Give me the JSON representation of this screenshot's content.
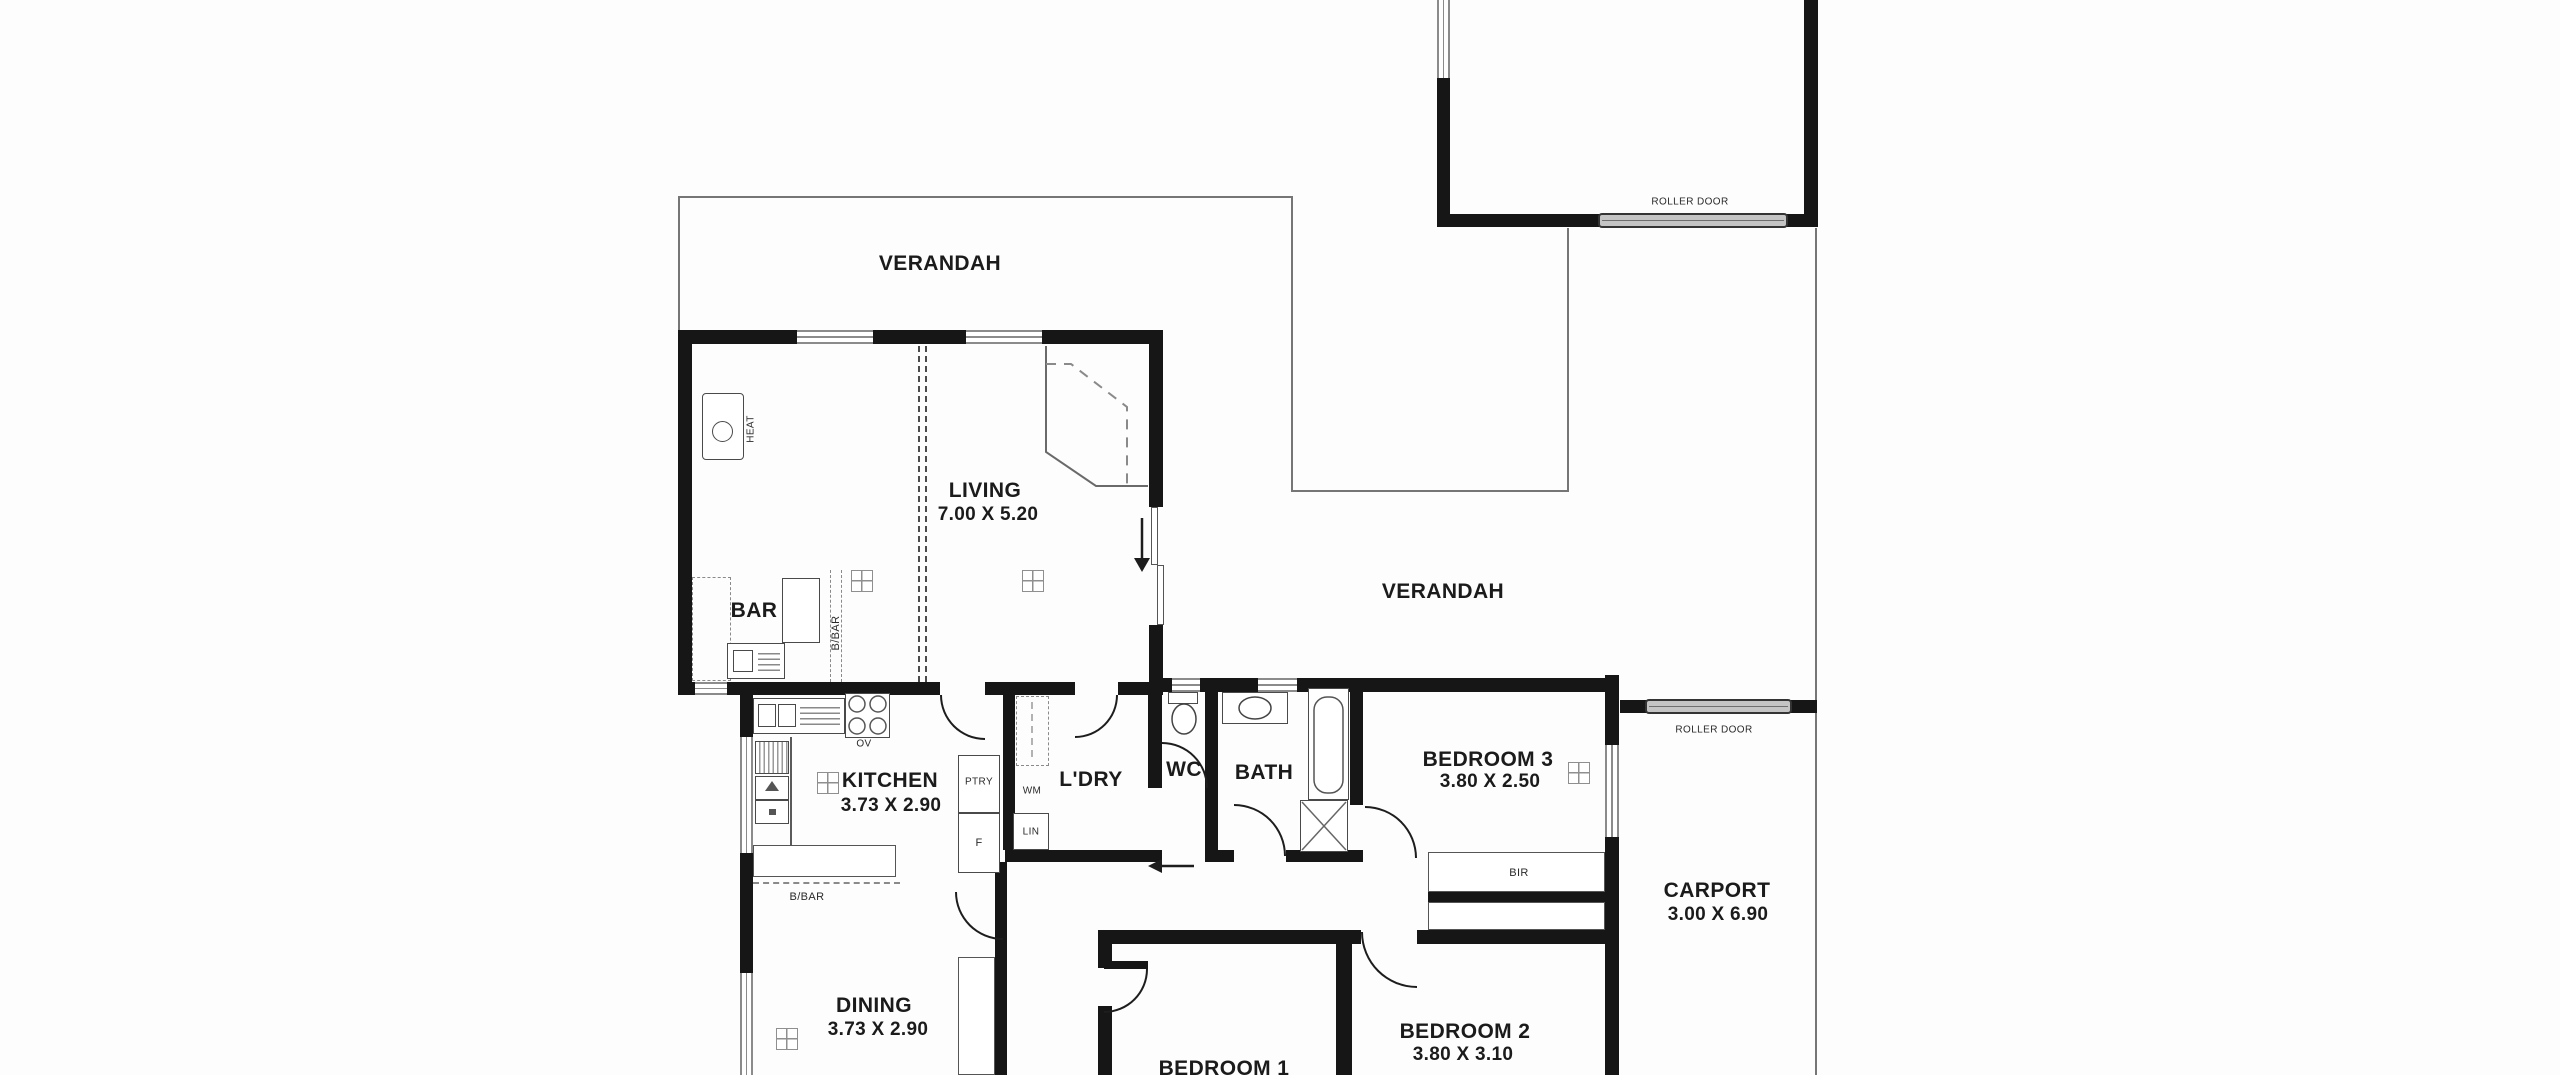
{
  "canvas": {
    "width": 2560,
    "height": 1075
  },
  "colors": {
    "wall": "#161616",
    "boundary_line": "#767676",
    "window": "#8b8b8b",
    "text": "#1b1b1b",
    "roller_fill": "#c4c4c4",
    "background": "#fdfdfd"
  },
  "areas": {
    "verandah_top": {
      "label": "VERANDAH"
    },
    "verandah_side": {
      "label": "VERANDAH"
    },
    "garage": {
      "roller_door": "ROLLER DOOR"
    },
    "carport": {
      "label": "CARPORT",
      "dims": "3.00 X 6.90",
      "roller_door": "ROLLER DOOR"
    },
    "living": {
      "label": "LIVING",
      "dims": "7.00 X 5.20"
    },
    "bar": {
      "label": "BAR"
    },
    "kitchen": {
      "label": "KITCHEN",
      "dims": "3.73 X 2.90"
    },
    "dining": {
      "label": "DINING",
      "dims": "3.73 X 2.90"
    },
    "laundry": {
      "label": "L'DRY"
    },
    "wc": {
      "label": "WC"
    },
    "bath": {
      "label": "BATH"
    },
    "bedroom1": {
      "label": "BEDROOM 1"
    },
    "bedroom2": {
      "label": "BEDROOM 2",
      "dims": "3.80 X 3.10"
    },
    "bedroom3": {
      "label": "BEDROOM 3",
      "dims": "3.80 X 2.50"
    }
  },
  "fixtures": {
    "heater": "HEAT",
    "oven": "OV",
    "pantry": "PTRY",
    "fridge": "F",
    "washing_machine": "WM",
    "linen": "LIN",
    "breakfast_bar_at_bar": "B/BAR",
    "breakfast_bar_at_kitchen": "B/BAR",
    "robe_bed3": "BIR",
    "robe_bed2": "BIR"
  }
}
